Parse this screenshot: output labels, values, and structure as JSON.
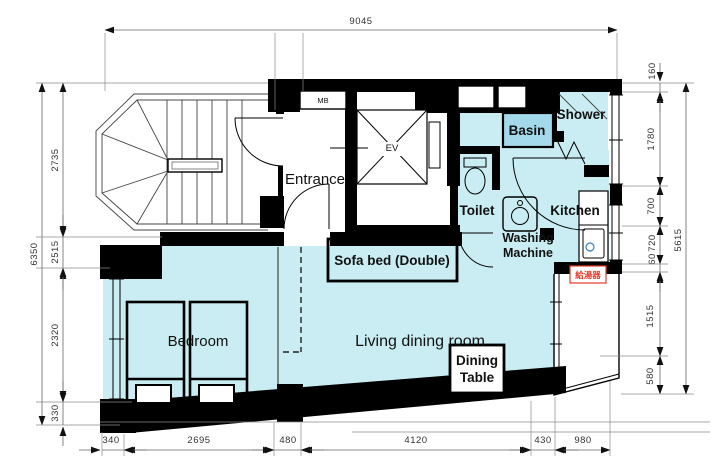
{
  "rooms": {
    "entrance": "Entrance",
    "living": "Living dining room",
    "bedroom": "Bedroom",
    "toilet": "Toilet",
    "kitchen": "Kitchen",
    "shower": "Shower",
    "basin": "Basin",
    "washing_line1": "Washing",
    "washing_line2": "Machine"
  },
  "fixtures": {
    "elevator": "EV",
    "meter_box": "MB",
    "water_heater": "給湯器"
  },
  "annotations": {
    "sofa_bed": "Sofa bed (Double)",
    "dining_line1": "Dining",
    "dining_line2": "Table"
  },
  "dimensions": {
    "top": {
      "total": "9045"
    },
    "left": {
      "total": "6350",
      "segments": [
        "2735",
        "2515",
        "2320",
        "330"
      ]
    },
    "right": {
      "total": "5615",
      "segments": [
        "160",
        "1780",
        "700",
        "720",
        "60",
        "1515",
        "580"
      ]
    },
    "bottom": {
      "segments": [
        "340",
        "2695",
        "480",
        "4120",
        "430",
        "980"
      ]
    }
  },
  "colors": {
    "floor": "#c9edf2",
    "basin_fill": "#a4d9ec",
    "wall": "#000000",
    "dimension_line": "#666666",
    "water_heater_red": "#e5392b"
  }
}
